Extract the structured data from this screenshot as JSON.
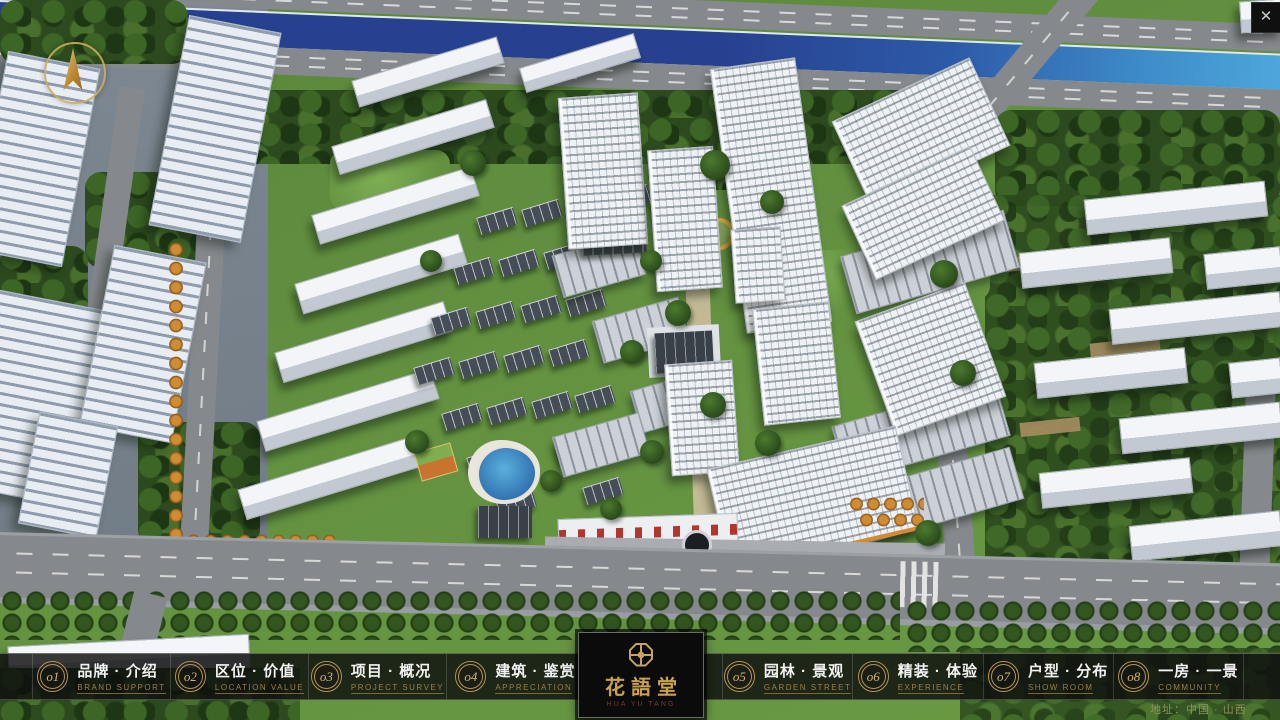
{
  "ui": {
    "close_glyph": "✕",
    "address": "地址：中国 · 山西"
  },
  "logo": {
    "title": "花語堂",
    "tagline": "HUA YU TANG"
  },
  "nav": {
    "items": [
      {
        "num": "o1",
        "label": "品牌 · 介绍",
        "sub": "BRAND SUPPORT"
      },
      {
        "num": "o2",
        "label": "区位 · 价值",
        "sub": "LOCATION VALUE"
      },
      {
        "num": "o3",
        "label": "项目 · 概况",
        "sub": "PROJECT SURVEY"
      },
      {
        "num": "o4",
        "label": "建筑 · 鉴赏",
        "sub": "APPRECIATION"
      },
      {
        "num": "o5",
        "label": "园林 · 景观",
        "sub": "GARDEN STREET"
      },
      {
        "num": "o6",
        "label": "精装 · 体验",
        "sub": "EXPERIENCE"
      },
      {
        "num": "o7",
        "label": "户型 · 分布",
        "sub": "SHOW ROOM"
      },
      {
        "num": "o8",
        "label": "一房 · 一景",
        "sub": "COMMUNITY"
      }
    ]
  },
  "colors": {
    "accent_gold": "#c9a35e",
    "bar_bg": "#0d0d0d",
    "nav_label": "#f2f2f2",
    "nav_sublabel": "#9c7f48",
    "address_text": "#8f915a",
    "river_blue": "#2b4fa0",
    "canopy_green": "#2c4a1d",
    "road_grey": "#85888c"
  }
}
